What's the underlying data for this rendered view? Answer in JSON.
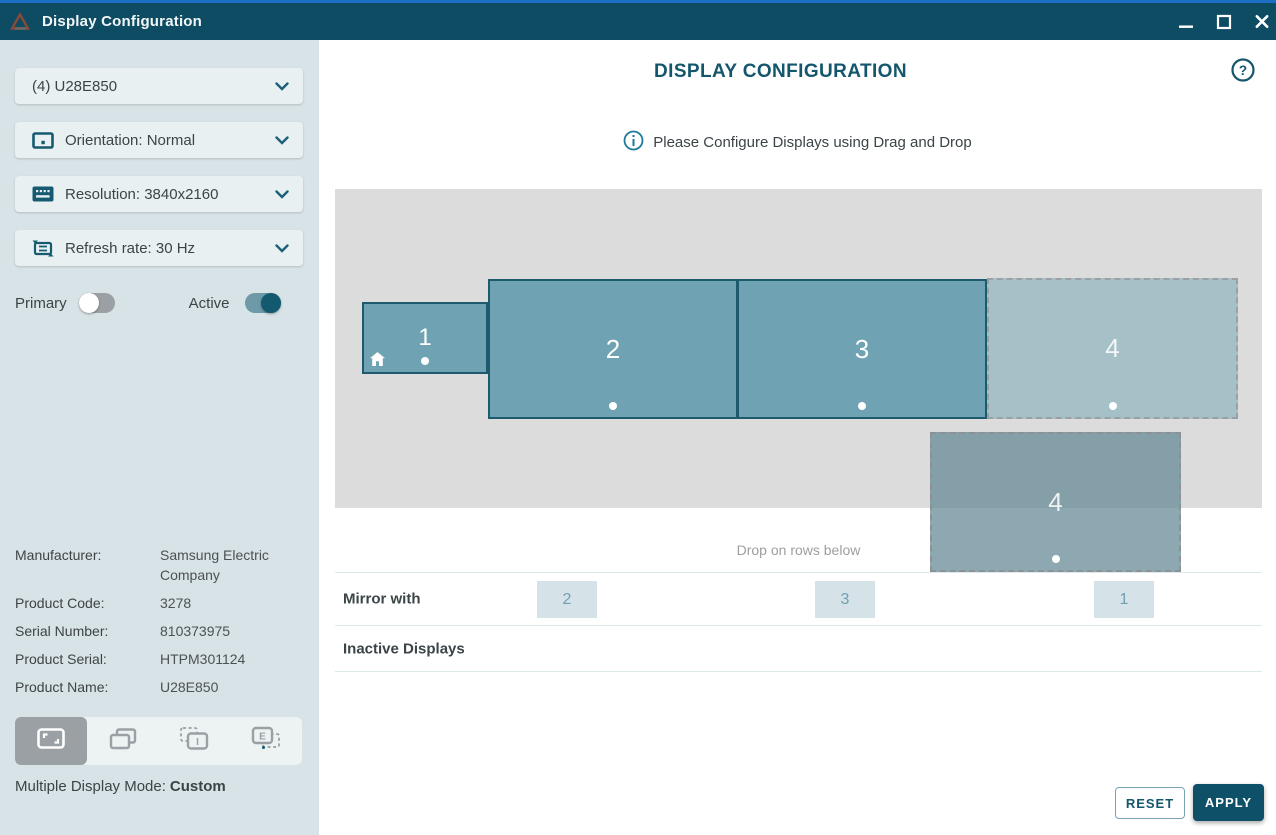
{
  "window": {
    "title": "Display Configuration"
  },
  "sidebar": {
    "display_select": {
      "label": "(4) U28E850"
    },
    "orientation": {
      "label": "Orientation: Normal"
    },
    "resolution": {
      "label": "Resolution: 3840x2160"
    },
    "refresh_rate": {
      "label": "Refresh rate: 30 Hz"
    },
    "primary_toggle": {
      "label": "Primary",
      "state": "off"
    },
    "active_toggle": {
      "label": "Active",
      "state": "on"
    },
    "details": [
      {
        "label": "Manufacturer:",
        "value": "Samsung Electric Company"
      },
      {
        "label": "Product Code:",
        "value": "3278"
      },
      {
        "label": "Serial Number:",
        "value": "810373975"
      },
      {
        "label": "Product Serial:",
        "value": "HTPM301124"
      },
      {
        "label": "Product Name:",
        "value": "U28E850"
      }
    ],
    "mode_toolbar": {
      "selected_mode": "custom",
      "internal_glyph": "I",
      "external_glyph": "E"
    },
    "mode_line": {
      "label": "Multiple Display Mode:",
      "value": "Custom"
    }
  },
  "main": {
    "heading": "DISPLAY CONFIGURATION",
    "info_text": "Please Configure Displays using Drag and Drop",
    "drop_hint": "Drop on rows below",
    "displays": {
      "display1": "1",
      "display2": "2",
      "display3": "3",
      "display4_ghost": "4",
      "display4_dragging": "4"
    },
    "mirror_row": {
      "label": "Mirror with",
      "chips": [
        "2",
        "3",
        "1"
      ]
    },
    "inactive_row": {
      "label": "Inactive Displays"
    },
    "reset_button": "RESET",
    "apply_button": "APPLY"
  },
  "colors": {
    "accent_teal": "#14576d",
    "titlebar": "#0d4c62",
    "top_stripe": "#1c6fc5",
    "display_fill": "#6fa3b4",
    "sidebar_bg": "#d8e3e7",
    "canvas_bg": "#dcdcdc"
  }
}
